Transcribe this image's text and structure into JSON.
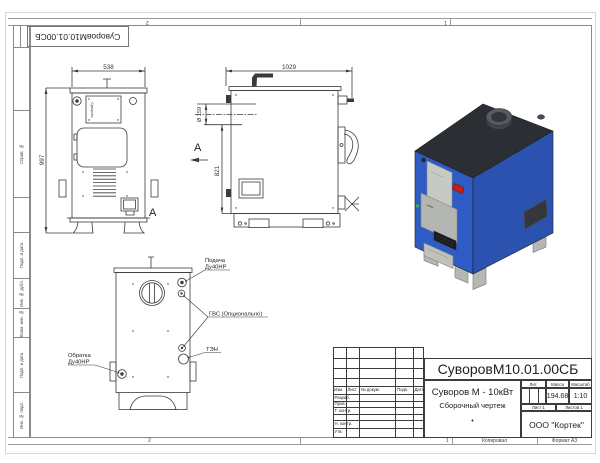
{
  "zones": {
    "top_left": "2",
    "top_right": "1",
    "bottom_left": "2",
    "bottom_right": "1"
  },
  "footer": {
    "copied_label": "Копировал",
    "format_label": "Формат А3"
  },
  "margin": {
    "labels": [
      "Справ. №",
      "Подп. и дата",
      "Инв. № дубл.",
      "Взам. инв. №",
      "Подп. и дата",
      "Инв. № подл."
    ]
  },
  "stamp": {
    "doc_number": "СуворовМ10.01.00СБ"
  },
  "front_view": {
    "dim_width": "538",
    "dim_height": "997",
    "view_label": "А",
    "brand": "Суворовъ"
  },
  "side_view": {
    "dim_width": "1029",
    "dim_height": "821",
    "dim_flue": "Ø 159",
    "view_label": "А"
  },
  "rear_view": {
    "supply_line1": "Подача",
    "supply_line2": "Ду40НР",
    "dhw": "ГВС (Опционально)",
    "heater": "ТЭН",
    "return_line1": "Обратка",
    "return_line2": "Ду40НР"
  },
  "titleblock": {
    "doc_number": "СуворовМ10.01.00СБ",
    "product": "Суворов М - 10кВт",
    "doc_type": "Сборочный чертеж",
    "center_dot": "•",
    "cols": {
      "izm": "Изм.",
      "list": "Лист",
      "doc": "№ докум.",
      "podp": "Подп.",
      "data": "Дата"
    },
    "rows": {
      "razrab": "Разраб.",
      "prov": "Пров.",
      "tkontr": "Т. контр.",
      "nkontr": "Н. контр.",
      "utv": "Утв."
    },
    "lit": "Лит.",
    "massa": "Масса",
    "masshtab": "Масштаб",
    "massa_value": "194.68",
    "scale_value": "1:10",
    "sheet": "Лист 1",
    "sheets": "Листов 1",
    "company": "ООО \"Кортек\""
  },
  "colors": {
    "body_blue_front": "#2e5cc4",
    "body_blue_side": "#2a52ae",
    "top_dark": "#2b2e33",
    "handle_red": "#c81e14",
    "line": "#3a3a3a"
  }
}
